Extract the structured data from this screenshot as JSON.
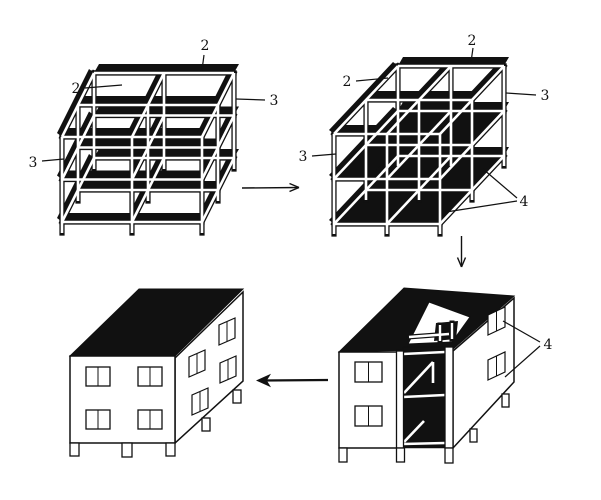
{
  "background": "#ffffff",
  "ink": "#111111",
  "labels": {
    "fig1": {
      "beam_top": "2",
      "beam_left": "2",
      "frame_right": "3",
      "frame_left": "3"
    },
    "fig2": {
      "beam_top": "2",
      "beam_left": "2",
      "frame_right": "3",
      "frame_left": "3",
      "slabs": "4"
    },
    "fig3": {
      "wall_panels": "4"
    }
  }
}
